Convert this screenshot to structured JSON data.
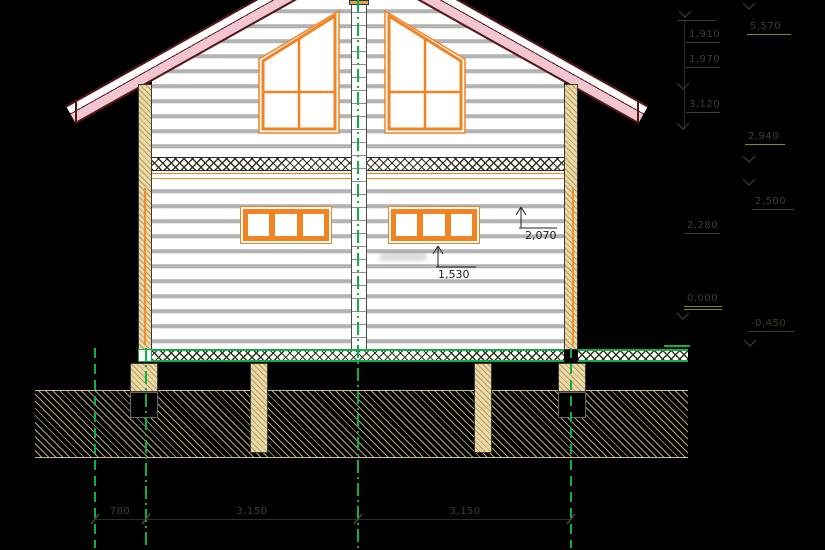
{
  "drawing_title": "log house facade elevation",
  "leaders": {
    "window_head": "2,070",
    "window_sill": "1,530"
  },
  "bottom_dims": [
    "780",
    "3,150",
    "3,150"
  ],
  "right_margin": {
    "ridge_level": "5,570",
    "dim_roof_upper": "1,910",
    "dim_roof_lower": "1,970",
    "dim_wall": "3,120",
    "eaves_level": "2,940",
    "mid_level": "2,500",
    "dim_floor": "2,280",
    "zero_level": "0,000",
    "ground_level": "-0,450"
  },
  "colors": {
    "axis_green": "#0fae4b",
    "window_orange": "#f28322",
    "roof_pink": "#f2c6d0",
    "roof_edge_dark_red": "#581818",
    "wood_tan": "#ecd9a3",
    "level_underline_olive": "#7a8c1e"
  }
}
